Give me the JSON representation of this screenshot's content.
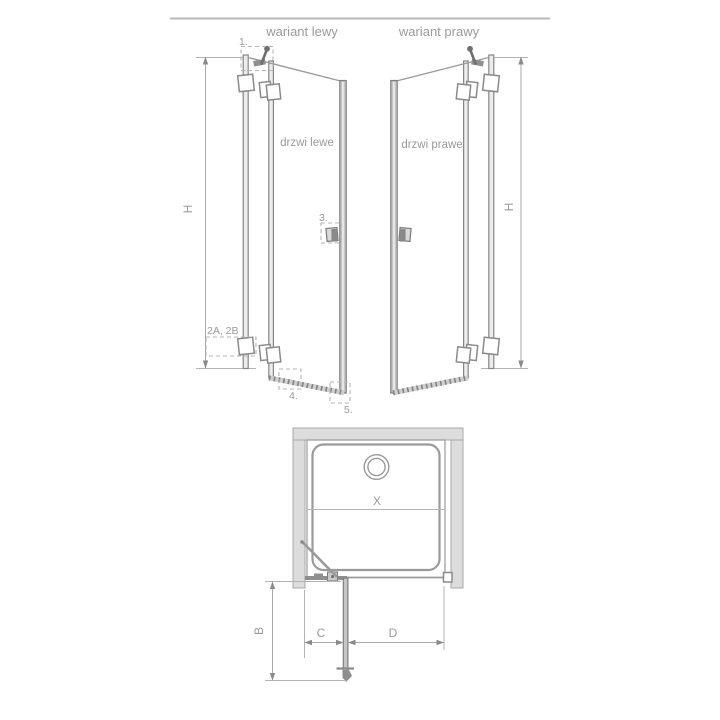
{
  "header": {
    "left_variant": "wariant lewy",
    "right_variant": "wariant prawy"
  },
  "left_view": {
    "door_label": "drzwi lewe",
    "height_dim": "H",
    "callout_1": "1.",
    "callout_2": "2A, 2B",
    "callout_3": "3.",
    "callout_4": "4.",
    "callout_5": "5."
  },
  "right_view": {
    "door_label": "drzwi prawe",
    "height_dim": "H"
  },
  "plan_view": {
    "inner_width_dim": "X",
    "depth_dim": "B",
    "door_offset_dim": "C",
    "door_width_dim": "D"
  },
  "colors": {
    "line_gray": "#9a9a9a",
    "profile_edge": "#878787",
    "profile_fill": "#ececec",
    "wall_fill": "#dcdcdc",
    "hardware_dark": "#6f6f6f",
    "top_rule": "#b9b9b9",
    "background": "#ffffff"
  }
}
